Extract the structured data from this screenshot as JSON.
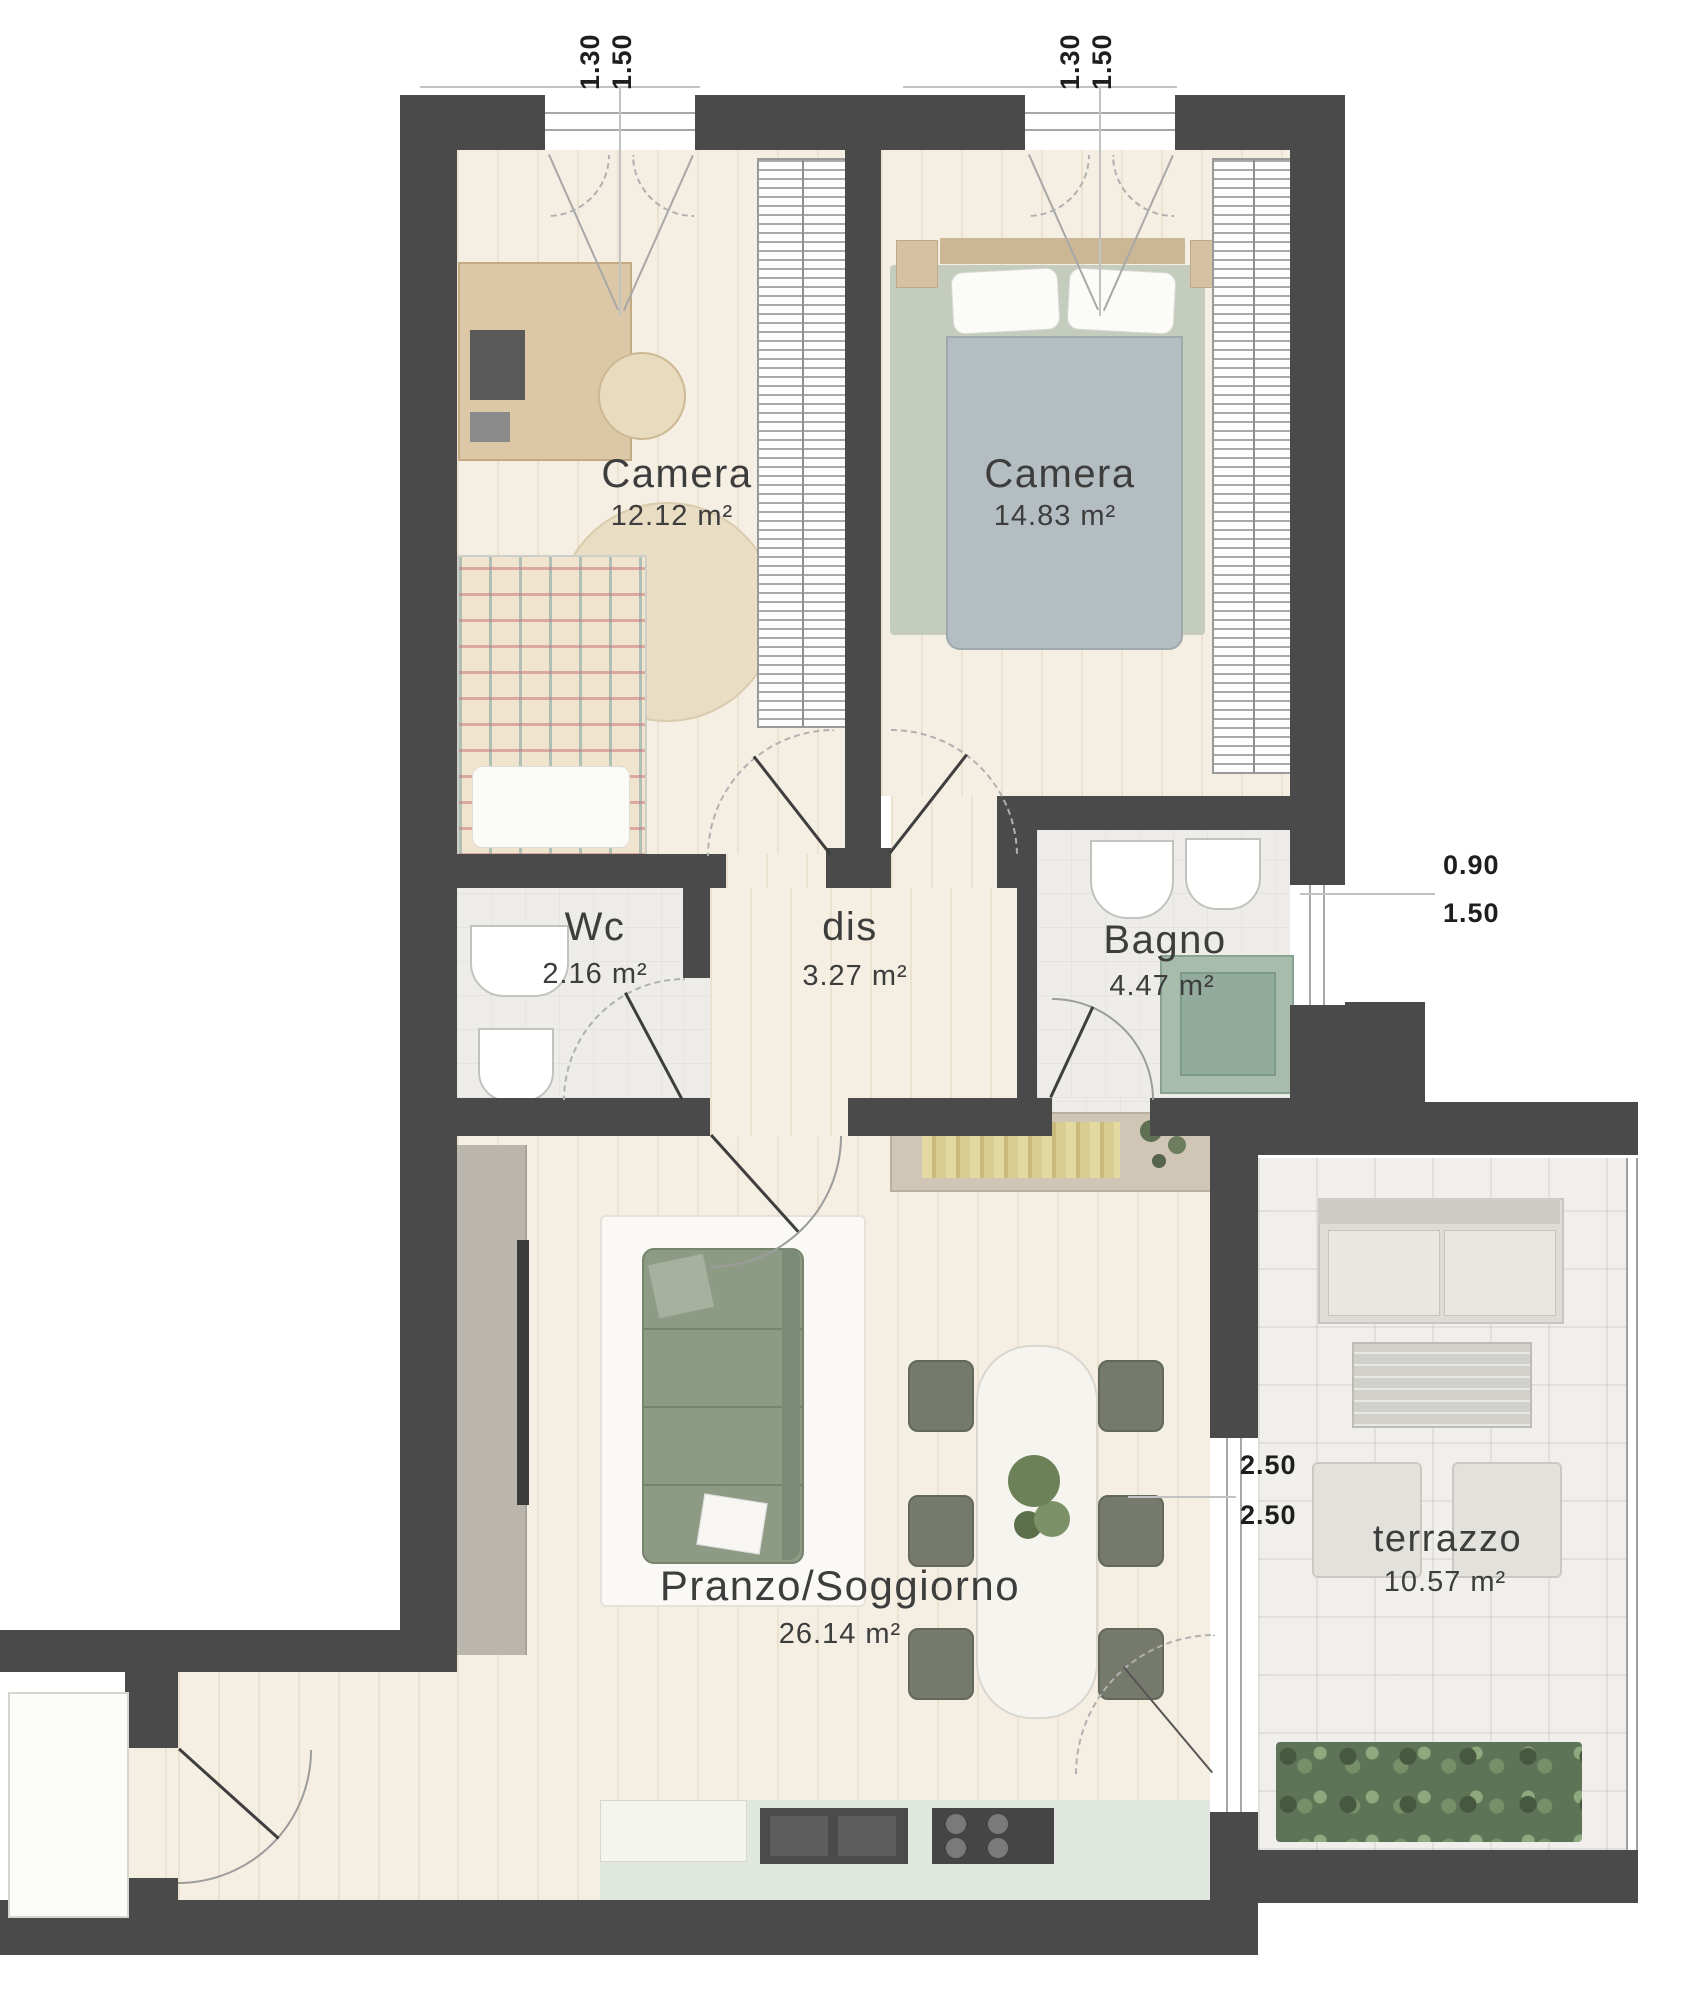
{
  "rooms": {
    "camera1": {
      "name": "Camera",
      "area": "12.12 m²"
    },
    "camera2": {
      "name": "Camera",
      "area": "14.83 m²"
    },
    "wc": {
      "name": "Wc",
      "area": "2.16 m²"
    },
    "dis": {
      "name": "dis",
      "area": "3.27 m²"
    },
    "bagno": {
      "name": "Bagno",
      "area": "4.47 m²"
    },
    "soggiorno": {
      "name": "Pranzo/Soggiorno",
      "area": "26.14 m²"
    },
    "terrazzo": {
      "name": "terrazzo",
      "area": "10.57 m²"
    }
  },
  "dimensions": {
    "window1": {
      "a": "1.30",
      "b": "1.50"
    },
    "window2": {
      "a": "1.30",
      "b": "1.50"
    },
    "bagno_window": {
      "a": "0.90",
      "b": "1.50"
    },
    "terrazzo": {
      "a": "2.50",
      "b": "2.50"
    }
  },
  "colors": {
    "wall": "#4a4a4b",
    "wood_floor": "#f5efe3",
    "bath_tile": "#edece8",
    "terrace_tile": "#f0efeb",
    "kitchen_counter": "#e0e7df",
    "sofa_green": "#8d9a84",
    "hedge_green": "#5e7457"
  }
}
